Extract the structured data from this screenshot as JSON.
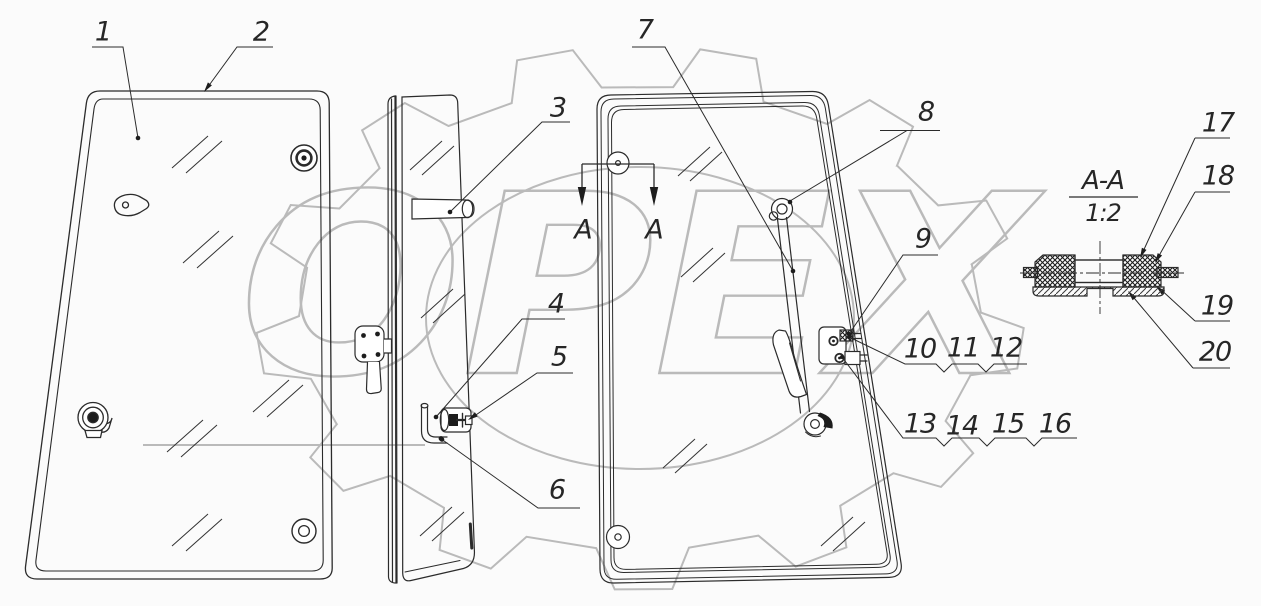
{
  "drawing": {
    "type": "exploded parts diagram — window glass panels with hinges, latches and grommet section",
    "background": "#fbfbfb",
    "line_color": "#2b2b2b",
    "watermark_color": "#bababa"
  },
  "watermark": {
    "text": "OPEX"
  },
  "section": {
    "title": "A-A",
    "scale": "1:2",
    "cut_label_left": "A",
    "cut_label_right": "A"
  },
  "callouts": [
    "1",
    "2",
    "3",
    "4",
    "5",
    "6",
    "7",
    "8",
    "9",
    "10",
    "11",
    "12",
    "13",
    "14",
    "15",
    "16",
    "17",
    "18",
    "19",
    "20"
  ]
}
